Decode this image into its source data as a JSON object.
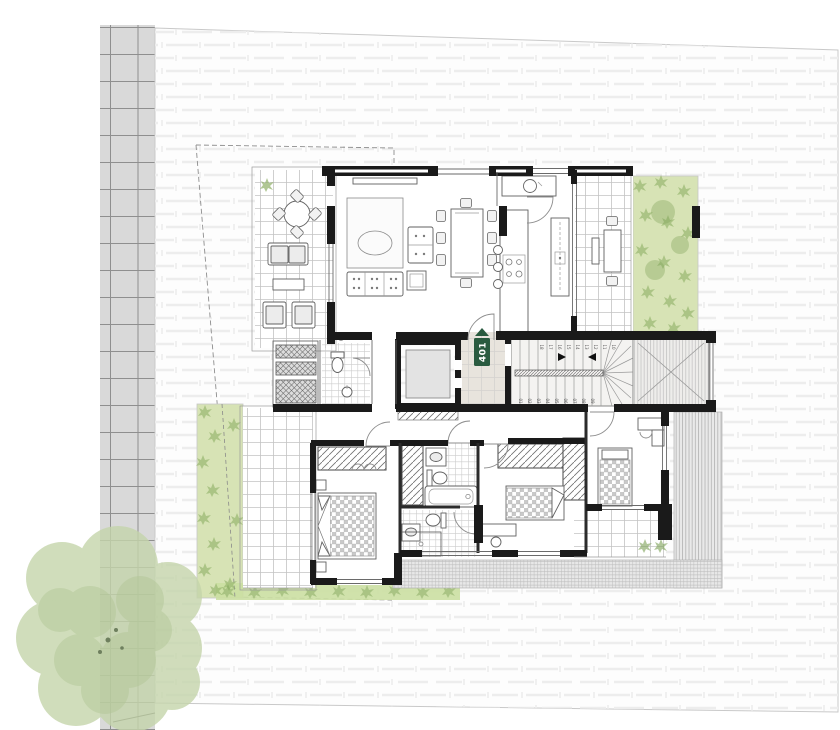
{
  "unit_badge": {
    "label": "401",
    "arrow_direction": "up"
  },
  "stairs": {
    "lower_flight_steps": [
      "01",
      "02",
      "03",
      "04",
      "05",
      "06",
      "07",
      "08",
      "09"
    ],
    "upper_flight_steps": [
      "18",
      "17",
      "16",
      "15",
      "14",
      "13",
      "12",
      "11",
      "10"
    ]
  },
  "colors": {
    "badge_green": "#2a5b40",
    "badge_text": "#ffffff",
    "garden_green": "#d7e3b5",
    "grass_green": "#cbdfa2",
    "shrub_green": "#8fb066",
    "shrub_dark": "#7da157",
    "tree_green": "#c5d5ab",
    "tree_green_dark": "#b0c594",
    "pavement_gray": "#d9d9d9",
    "landing_floor": "#e8e4dd",
    "elevator_car": "#e3e3e3",
    "wall_black": "#1a1a1a",
    "plot_white": "#fdfdfd"
  }
}
